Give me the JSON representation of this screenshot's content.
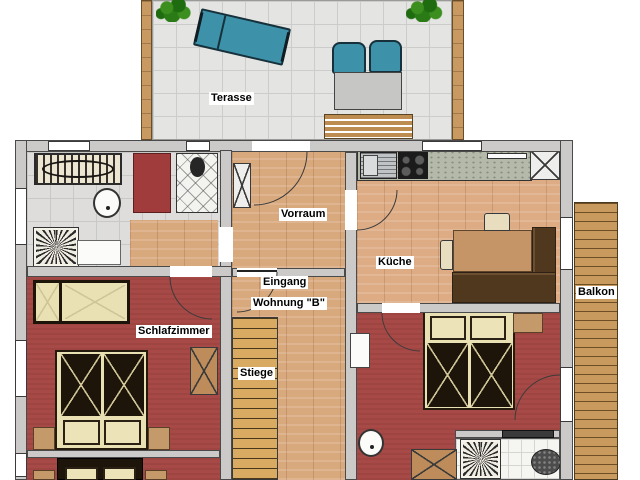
{
  "plan": {
    "labels": {
      "terrace": "Terasse",
      "vorraum": "Vorraum",
      "kitchen": "Küche",
      "entrance_line1": "Eingang",
      "entrance_line2": "Wohnung \"B\"",
      "stairs": "Stiege",
      "bedroom": "Schlafzimmer",
      "balcony": "Balkon"
    },
    "colors": {
      "wall": "#cbcac8",
      "terrace_tile": "#e4e4e2",
      "bathroom_tile": "#dedddb",
      "wood_floor": "#d9a97e",
      "bedroom_floor": "#a74946",
      "balcony_deck": "#c89a5d",
      "stairs_wood": "#d9aa62",
      "teal_furniture": "#3d92aa",
      "dark_bench": "#50381f",
      "red_bench": "#a03c3c",
      "plant_green": "#2a7a16"
    }
  }
}
